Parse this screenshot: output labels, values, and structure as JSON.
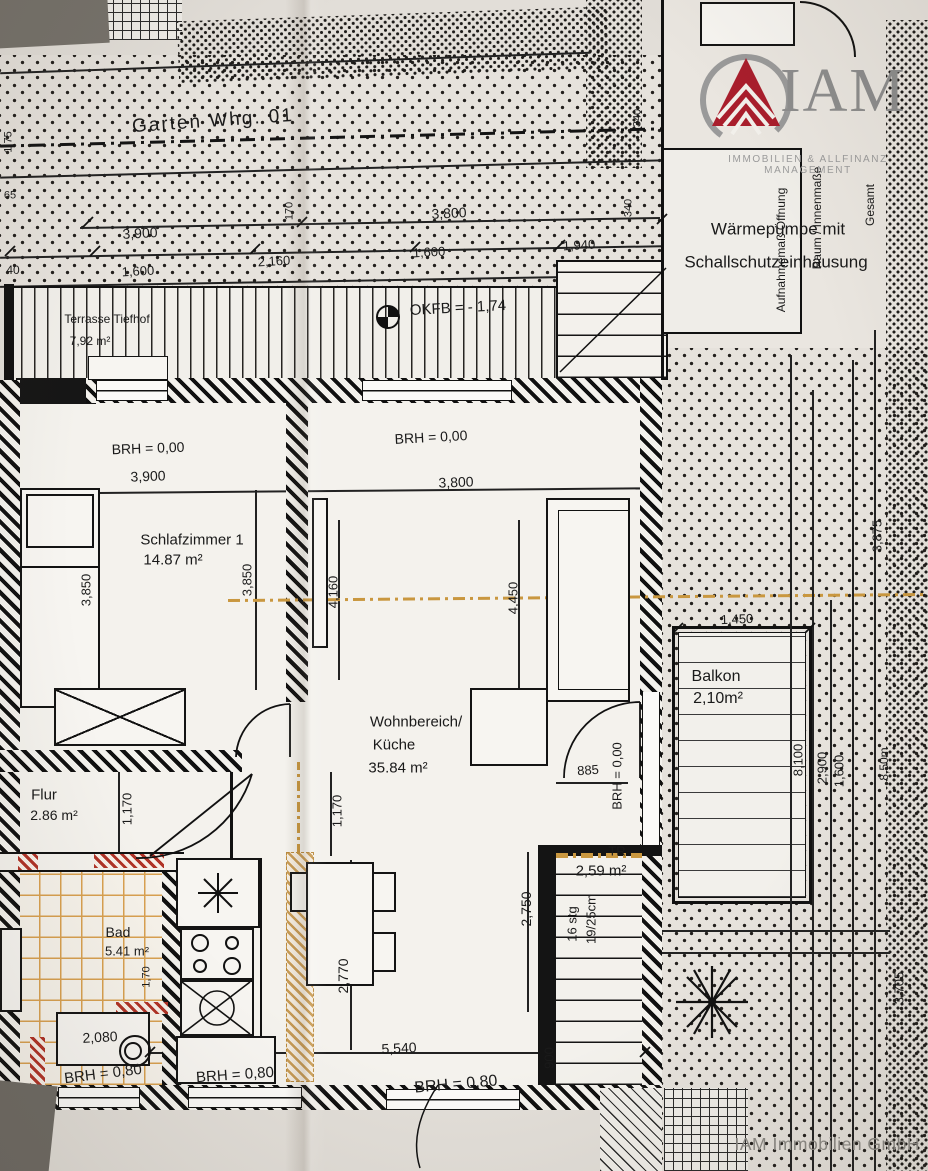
{
  "colors": {
    "paper": "#e2ded8",
    "ink": "#1a1a1a",
    "accent_red": "#a91e2c",
    "tile_orange": "#d8a050",
    "logo_gray": "#909090"
  },
  "logo": {
    "name": "IAM",
    "subtitle": "IMMOBILIEN & ALLFINANZ MANAGEMENT"
  },
  "watermark": "IAM Immobilien GmbH",
  "labels": [
    {
      "n": "garden-label",
      "t": "Garten Whg. 01",
      "x": 213,
      "y": 121,
      "r": -4,
      "s": 19,
      "ls": 2
    },
    {
      "n": "dim-1-75",
      "t": "1,75",
      "x": 9,
      "y": 142,
      "r": -90,
      "s": 11
    },
    {
      "n": "dim-65",
      "t": "65",
      "x": 10,
      "y": 196,
      "r": 0,
      "s": 11
    },
    {
      "n": "dim-3900-site",
      "t": "3,900",
      "x": 140,
      "y": 233,
      "r": -3,
      "s": 14
    },
    {
      "n": "dim-170",
      "t": "170",
      "x": 290,
      "y": 211,
      "r": -90,
      "s": 11
    },
    {
      "n": "dim-2160",
      "t": "2,160",
      "x": 274,
      "y": 261,
      "r": -3,
      "s": 13
    },
    {
      "n": "dim-1600-left",
      "t": "1,600",
      "x": 138,
      "y": 271,
      "r": -3,
      "s": 13
    },
    {
      "n": "dim-40",
      "t": "40",
      "x": 13,
      "y": 270,
      "r": 0,
      "s": 12
    },
    {
      "n": "dim-3800-site",
      "t": "3,800",
      "x": 449,
      "y": 213,
      "r": -3,
      "s": 14
    },
    {
      "n": "dim-1600-mid",
      "t": "1,600",
      "x": 429,
      "y": 252,
      "r": -3,
      "s": 13
    },
    {
      "n": "dim-1940",
      "t": "1,940",
      "x": 579,
      "y": 245,
      "r": -3,
      "s": 13
    },
    {
      "n": "dim-340-upper",
      "t": "340",
      "x": 638,
      "y": 118,
      "r": -90,
      "s": 11
    },
    {
      "n": "dim-340-lower",
      "t": "340",
      "x": 629,
      "y": 208,
      "r": -90,
      "s": 11
    },
    {
      "n": "heat-pump-line1",
      "t": "Wärmepumpe mit",
      "x": 778,
      "y": 229,
      "r": 0,
      "s": 17
    },
    {
      "n": "heat-pump-line2",
      "t": "Schallschutzeinhausung",
      "x": 776,
      "y": 262,
      "r": 0,
      "s": 17
    },
    {
      "n": "level-note",
      "t": "OKFB = - 1,74",
      "x": 458,
      "y": 308,
      "r": -3,
      "s": 15
    },
    {
      "n": "room-terrasse-name",
      "t": "Terrasse Tiefhof",
      "x": 107,
      "y": 319,
      "r": 0,
      "s": 12
    },
    {
      "n": "room-terrasse-area",
      "t": "7,92 m²",
      "x": 90,
      "y": 341,
      "r": 0,
      "s": 12
    },
    {
      "n": "sill-height-1",
      "t": "BRH = 0,00",
      "x": 148,
      "y": 448,
      "r": -2,
      "s": 14
    },
    {
      "n": "dim-3900-room",
      "t": "3,900",
      "x": 148,
      "y": 476,
      "r": -2,
      "s": 14
    },
    {
      "n": "sill-height-2",
      "t": "BRH = 0,00",
      "x": 431,
      "y": 437,
      "r": -3,
      "s": 14
    },
    {
      "n": "dim-3800-room",
      "t": "3,800",
      "x": 456,
      "y": 482,
      "r": -2,
      "s": 14
    },
    {
      "n": "room-schlafzimmer-name",
      "t": "Schlafzimmer 1",
      "x": 192,
      "y": 540,
      "r": 0,
      "s": 15
    },
    {
      "n": "room-schlafzimmer-area",
      "t": "14.87 m²",
      "x": 173,
      "y": 560,
      "r": 0,
      "s": 15
    },
    {
      "n": "dim-3850-a",
      "t": "3,850",
      "x": 86,
      "y": 590,
      "r": -90,
      "s": 13
    },
    {
      "n": "dim-3850-b",
      "t": "3,850",
      "x": 247,
      "y": 580,
      "r": -90,
      "s": 13
    },
    {
      "n": "dim-4160",
      "t": "4,160",
      "x": 333,
      "y": 592,
      "r": -90,
      "s": 13
    },
    {
      "n": "dim-4450",
      "t": "4,450",
      "x": 513,
      "y": 598,
      "r": -90,
      "s": 13
    },
    {
      "n": "room-wohnbereich-name1",
      "t": "Wohnbereich/",
      "x": 416,
      "y": 722,
      "r": 0,
      "s": 15
    },
    {
      "n": "room-wohnbereich-name2",
      "t": "Küche",
      "x": 394,
      "y": 745,
      "r": 0,
      "s": 15
    },
    {
      "n": "room-wohnbereich-area",
      "t": "35.84 m²",
      "x": 398,
      "y": 768,
      "r": 0,
      "s": 15
    },
    {
      "n": "dim-885",
      "t": "885",
      "x": 588,
      "y": 770,
      "r": -4,
      "s": 13
    },
    {
      "n": "sill-height-3",
      "t": "BRH = 0,00",
      "x": 617,
      "y": 776,
      "r": -90,
      "s": 13
    },
    {
      "n": "room-balkon-name",
      "t": "Balkon",
      "x": 716,
      "y": 677,
      "r": 0,
      "s": 16
    },
    {
      "n": "room-balkon-area",
      "t": "2,10m²",
      "x": 718,
      "y": 699,
      "r": 0,
      "s": 16
    },
    {
      "n": "dim-1450",
      "t": "1,450",
      "x": 737,
      "y": 619,
      "r": -2,
      "s": 13
    },
    {
      "n": "dim-8100",
      "t": "8,100",
      "x": 798,
      "y": 760,
      "r": -90,
      "s": 13
    },
    {
      "n": "dim-2900",
      "t": "2,900",
      "x": 822,
      "y": 768,
      "r": -90,
      "s": 13
    },
    {
      "n": "dim-1600-right",
      "t": "1,600",
      "x": 839,
      "y": 771,
      "r": -90,
      "s": 13
    },
    {
      "n": "dim-850m",
      "t": "8,50m",
      "x": 884,
      "y": 764,
      "r": -90,
      "s": 12
    },
    {
      "n": "dim-3875",
      "t": "3,875",
      "x": 877,
      "y": 536,
      "r": -90,
      "s": 13
    },
    {
      "n": "dim-3705",
      "t": "3,705",
      "x": 899,
      "y": 988,
      "r": -90,
      "s": 13
    },
    {
      "n": "room-flur-name",
      "t": "Flur",
      "x": 44,
      "y": 795,
      "r": 0,
      "s": 15
    },
    {
      "n": "room-flur-area",
      "t": "2.86 m²",
      "x": 54,
      "y": 815,
      "r": 0,
      "s": 14
    },
    {
      "n": "dim-1170-a",
      "t": "1,170",
      "x": 127,
      "y": 809,
      "r": -90,
      "s": 13
    },
    {
      "n": "dim-1170-b",
      "t": "1,170",
      "x": 337,
      "y": 811,
      "r": -90,
      "s": 13
    },
    {
      "n": "room-bad-name",
      "t": "Bad",
      "x": 118,
      "y": 932,
      "r": 0,
      "s": 14
    },
    {
      "n": "room-bad-area",
      "t": "5.41 m²",
      "x": 127,
      "y": 951,
      "r": 0,
      "s": 13
    },
    {
      "n": "dim-1-70",
      "t": "1,70",
      "x": 147,
      "y": 977,
      "r": -90,
      "s": 11
    },
    {
      "n": "room-tr-name",
      "t": "TR",
      "x": 617,
      "y": 851,
      "r": 0,
      "s": 13
    },
    {
      "n": "room-tr-area",
      "t": "2,59 m²",
      "x": 601,
      "y": 871,
      "r": 0,
      "s": 15
    },
    {
      "n": "stair-steps",
      "t": "16 stg",
      "x": 572,
      "y": 924,
      "r": -90,
      "s": 13
    },
    {
      "n": "stair-riser",
      "t": "19/25cm",
      "x": 591,
      "y": 919,
      "r": -90,
      "s": 13
    },
    {
      "n": "dim-2750",
      "t": "2,750",
      "x": 526,
      "y": 909,
      "r": -90,
      "s": 14
    },
    {
      "n": "dim-2770",
      "t": "2,770",
      "x": 343,
      "y": 976,
      "r": -90,
      "s": 14
    },
    {
      "n": "dim-5540",
      "t": "5,540",
      "x": 399,
      "y": 1048,
      "r": -3,
      "s": 14
    },
    {
      "n": "sill-height-4",
      "t": "BRH = 0,80",
      "x": 456,
      "y": 1085,
      "r": -5,
      "s": 16
    },
    {
      "n": "dim-900",
      "t": "900",
      "x": 549,
      "y": 1058,
      "r": -90,
      "s": 13
    },
    {
      "n": "dim-2080",
      "t": "2,080",
      "x": 100,
      "y": 1037,
      "r": -3,
      "s": 14
    },
    {
      "n": "sill-height-5",
      "t": "BRH = 0,80",
      "x": 103,
      "y": 1074,
      "r": -7,
      "s": 15
    },
    {
      "n": "sill-height-6",
      "t": "BRH = 0,80",
      "x": 235,
      "y": 1075,
      "r": -4,
      "s": 15
    },
    {
      "n": "note-aufnahme",
      "t": "Aufnahmemaß Öffnung",
      "x": 781,
      "y": 250,
      "r": -90,
      "s": 12
    },
    {
      "n": "note-raum-innenmasse",
      "t": "Raum / Innenmaße",
      "x": 817,
      "y": 218,
      "r": -90,
      "s": 12
    },
    {
      "n": "note-gesamt",
      "t": "Gesamt",
      "x": 870,
      "y": 205,
      "r": -90,
      "s": 12
    }
  ]
}
